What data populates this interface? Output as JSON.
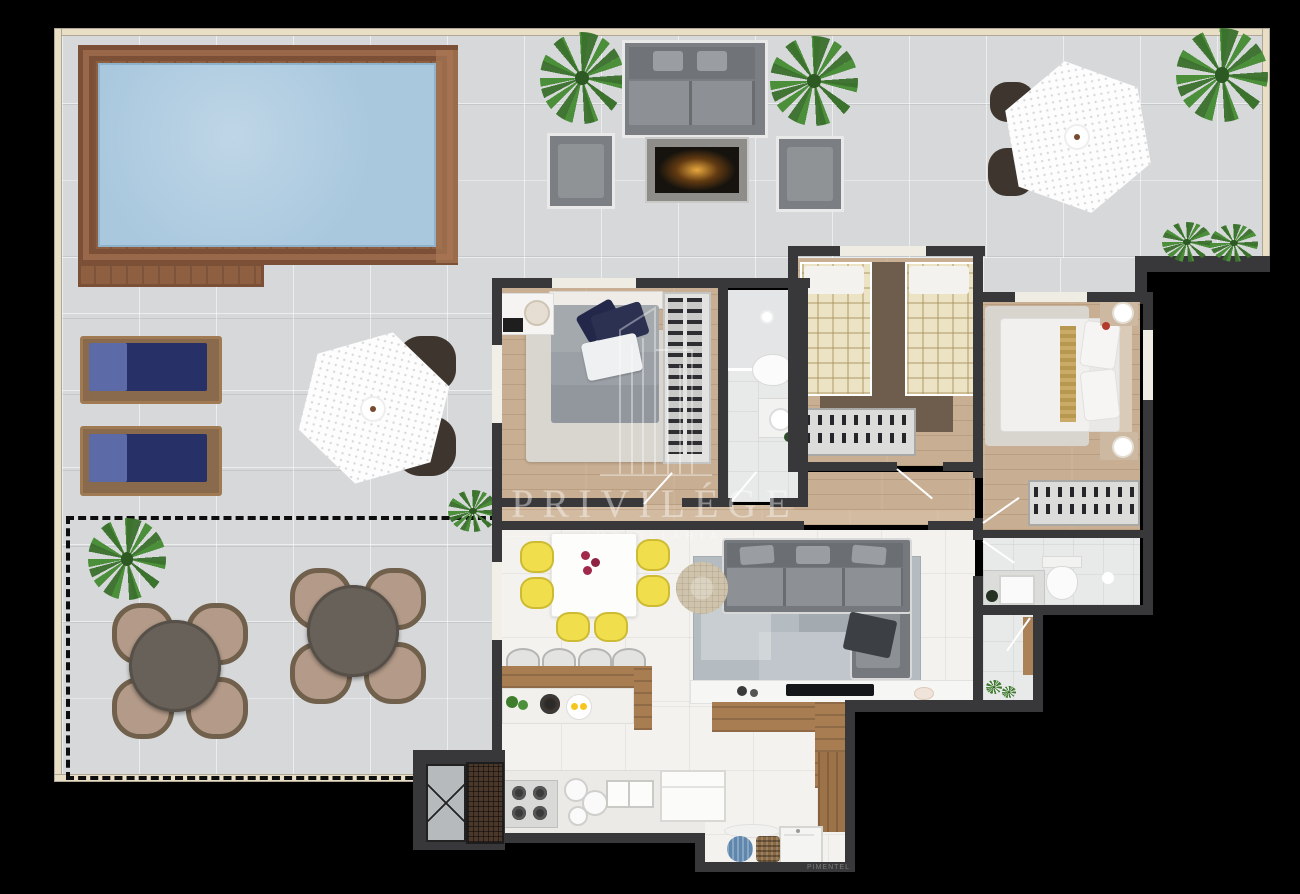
{
  "watermark": {
    "brand": "PRIVILÉGE",
    "subtitle": "IMOBILIÁRIA",
    "credit": "PIMENTEL"
  },
  "colors": {
    "wall": "#38383a",
    "outer_wall": "#e9dfc7",
    "terrace_tile": "#d6d8da",
    "pool_water": "#a9c8de",
    "deck_wood": "#8e5f41",
    "deck_wood_light": "#a97854",
    "wood_floor": "#c8ae92",
    "white_floor": "#f3f2ef",
    "bath_floor": "#e8e9e9",
    "rug_gray": "#b4bbc1",
    "sofa_gray": "#7e8286",
    "chair_yellow": "#f1de4d",
    "lounger_navy": "#273168",
    "patio_chair": "#b49b89",
    "patio_table": "#686159",
    "plant_green": "#4c8f3a",
    "fire_glow": "#e8a83e",
    "console_wood": "#a87d52",
    "watermark": "#ffffff"
  }
}
